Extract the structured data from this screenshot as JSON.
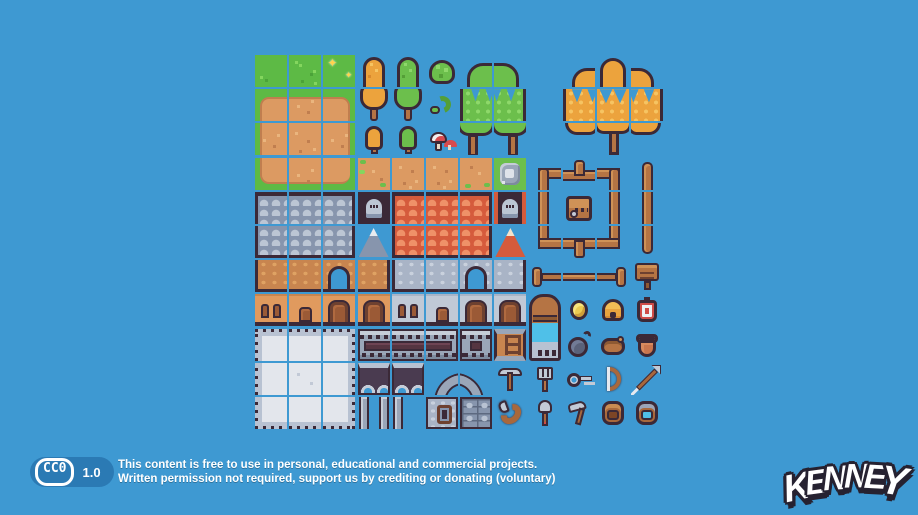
{
  "palette": {
    "background_blue": "#3e99d2",
    "badge_blue": "#2b7ab4",
    "outline_dark": "#3b2937",
    "grass_green": "#5dba45",
    "dirt_tan": "#dc9a62",
    "tree_orange": "#eca33d",
    "tree_green": "#6cbf4c",
    "roof_gray": "#8795ad",
    "roof_orange": "#d55b3c",
    "wood_brown": "#b57444",
    "stone_light": "#e3e6ec",
    "water_cyan": "#4fc0e8",
    "accent_red": "#cf4b47",
    "coin_gold": "#eccb52"
  },
  "badge": {
    "cc_label": "CC0",
    "version": "1.0",
    "line1": "This content is free to use in personal, educational and commercial projects.",
    "line2": "Written permission not required, support us by crediting or donating (voluntary)"
  },
  "logo": {
    "text": "KENNEY",
    "letters": [
      "K",
      "E",
      "N",
      "N",
      "E",
      "Y"
    ]
  },
  "sheet": {
    "origin_x": 255,
    "origin_y": 55,
    "tile": 32,
    "pitch": 34.2,
    "cols": 12,
    "rows": 11,
    "cells": [
      [
        0,
        0,
        "grass"
      ],
      [
        0,
        1,
        "grass2"
      ],
      [
        0,
        2,
        "grass3"
      ],
      [
        0,
        3,
        "pineO-top"
      ],
      [
        0,
        4,
        "pineG-top"
      ],
      [
        0,
        5,
        "bush"
      ],
      [
        0,
        6,
        "btG-tl"
      ],
      [
        0,
        7,
        "btG-tr"
      ],
      [
        0,
        9,
        "btO-tl"
      ],
      [
        0,
        10,
        "btO-tc"
      ],
      [
        0,
        11,
        "btO-tr"
      ],
      [
        1,
        0,
        "dirt-tl"
      ],
      [
        1,
        1,
        "dirt-t"
      ],
      [
        1,
        2,
        "dirt-tr"
      ],
      [
        1,
        3,
        "pineO-bot"
      ],
      [
        1,
        4,
        "pineG-bot"
      ],
      [
        1,
        5,
        "vine"
      ],
      [
        1,
        6,
        "btG-ml"
      ],
      [
        1,
        7,
        "btG-mr"
      ],
      [
        1,
        9,
        "btO-ml"
      ],
      [
        1,
        10,
        "btO-mc"
      ],
      [
        1,
        11,
        "btO-mr"
      ],
      [
        2,
        0,
        "dirt-l"
      ],
      [
        2,
        1,
        "dirt-c"
      ],
      [
        2,
        2,
        "dirt-r"
      ],
      [
        2,
        3,
        "treeO-sm"
      ],
      [
        2,
        4,
        "treeG-sm"
      ],
      [
        2,
        5,
        "mushrooms"
      ],
      [
        2,
        6,
        "btG-bl"
      ],
      [
        2,
        7,
        "btG-br"
      ],
      [
        2,
        9,
        "btO-bl"
      ],
      [
        2,
        10,
        "btO-bc"
      ],
      [
        2,
        11,
        "btO-br"
      ],
      [
        3,
        0,
        "dirt-bl"
      ],
      [
        3,
        1,
        "dirt-b"
      ],
      [
        3,
        2,
        "dirt-br"
      ],
      [
        3,
        3,
        "dirt-g1"
      ],
      [
        3,
        4,
        "dirt-p"
      ],
      [
        3,
        5,
        "dirt-p"
      ],
      [
        3,
        6,
        "dirt-g2"
      ],
      [
        3,
        7,
        "grass-stones"
      ],
      [
        3,
        8,
        "fence-tl"
      ],
      [
        3,
        9,
        "fence-tt"
      ],
      [
        3,
        10,
        "fence-tr"
      ],
      [
        3,
        11,
        "post-top"
      ],
      [
        4,
        0,
        "roofG-a"
      ],
      [
        4,
        1,
        "roofG-b"
      ],
      [
        4,
        2,
        "roofG-c"
      ],
      [
        4,
        3,
        "atticG"
      ],
      [
        4,
        4,
        "roofO-a"
      ],
      [
        4,
        5,
        "roofO-b"
      ],
      [
        4,
        6,
        "roofO-c"
      ],
      [
        4,
        7,
        "atticO"
      ],
      [
        4,
        8,
        "fence-vl"
      ],
      [
        4,
        9,
        "chest"
      ],
      [
        4,
        10,
        "fence-vr"
      ],
      [
        4,
        11,
        "post-mid"
      ],
      [
        5,
        0,
        "roofG-d"
      ],
      [
        5,
        1,
        "roofG-e"
      ],
      [
        5,
        2,
        "roofG-f"
      ],
      [
        5,
        3,
        "peakG"
      ],
      [
        5,
        4,
        "roofO-d"
      ],
      [
        5,
        5,
        "roofO-e"
      ],
      [
        5,
        6,
        "roofO-f"
      ],
      [
        5,
        7,
        "peakO"
      ],
      [
        5,
        8,
        "fence-bl"
      ],
      [
        5,
        9,
        "fence-tb"
      ],
      [
        5,
        10,
        "fence-br"
      ],
      [
        5,
        11,
        "post-bot"
      ],
      [
        6,
        0,
        "wallB-l"
      ],
      [
        6,
        1,
        "wallB-m"
      ],
      [
        6,
        2,
        "wallB-arch"
      ],
      [
        6,
        3,
        "wallB-r"
      ],
      [
        6,
        4,
        "wallG-l"
      ],
      [
        6,
        5,
        "wallG-m"
      ],
      [
        6,
        6,
        "wallG-arch"
      ],
      [
        6,
        7,
        "wallG-r"
      ],
      [
        6,
        8,
        "hfence-l"
      ],
      [
        6,
        9,
        "hfence-m"
      ],
      [
        6,
        10,
        "hfence-r"
      ],
      [
        6,
        11,
        "sign"
      ],
      [
        7,
        0,
        "winB"
      ],
      [
        7,
        1,
        "doorB-s"
      ],
      [
        7,
        2,
        "doorB"
      ],
      [
        7,
        3,
        "doorB2"
      ],
      [
        7,
        4,
        "winG"
      ],
      [
        7,
        5,
        "doorG-s"
      ],
      [
        7,
        6,
        "doorG"
      ],
      [
        7,
        7,
        "doorG2"
      ],
      [
        7,
        8,
        "well",
        2
      ],
      [
        7,
        9,
        "coin"
      ],
      [
        7,
        10,
        "beehive"
      ],
      [
        7,
        11,
        "target"
      ],
      [
        8,
        0,
        "plat-tl"
      ],
      [
        8,
        1,
        "plat-t"
      ],
      [
        8,
        2,
        "plat-tr"
      ],
      [
        8,
        3,
        "slot-l"
      ],
      [
        8,
        4,
        "slot-m"
      ],
      [
        8,
        5,
        "slot-r"
      ],
      [
        8,
        6,
        "slot-s"
      ],
      [
        8,
        7,
        "ladder"
      ],
      [
        8,
        9,
        "bomb"
      ],
      [
        8,
        10,
        "pouch"
      ],
      [
        8,
        11,
        "pot"
      ],
      [
        9,
        0,
        "plat-l"
      ],
      [
        9,
        1,
        "plat-c"
      ],
      [
        9,
        2,
        "plat-r"
      ],
      [
        9,
        3,
        "arches-l"
      ],
      [
        9,
        4,
        "arches-r"
      ],
      [
        9,
        5,
        "archL"
      ],
      [
        9,
        6,
        "archR"
      ],
      [
        9,
        7,
        "pickaxe"
      ],
      [
        9,
        8,
        "fork"
      ],
      [
        9,
        9,
        "key"
      ],
      [
        9,
        10,
        "bow"
      ],
      [
        9,
        11,
        "arrow"
      ],
      [
        10,
        0,
        "plat-bl"
      ],
      [
        10,
        1,
        "plat-b"
      ],
      [
        10,
        2,
        "plat-br"
      ],
      [
        10,
        3,
        "legs2"
      ],
      [
        10,
        4,
        "leg1"
      ],
      [
        10,
        5,
        "win-stone"
      ],
      [
        10,
        6,
        "bricks"
      ],
      [
        10,
        7,
        "horn"
      ],
      [
        10,
        8,
        "shovel"
      ],
      [
        10,
        9,
        "hammer"
      ],
      [
        10,
        10,
        "bag"
      ],
      [
        10,
        11,
        "bagblue"
      ]
    ]
  }
}
